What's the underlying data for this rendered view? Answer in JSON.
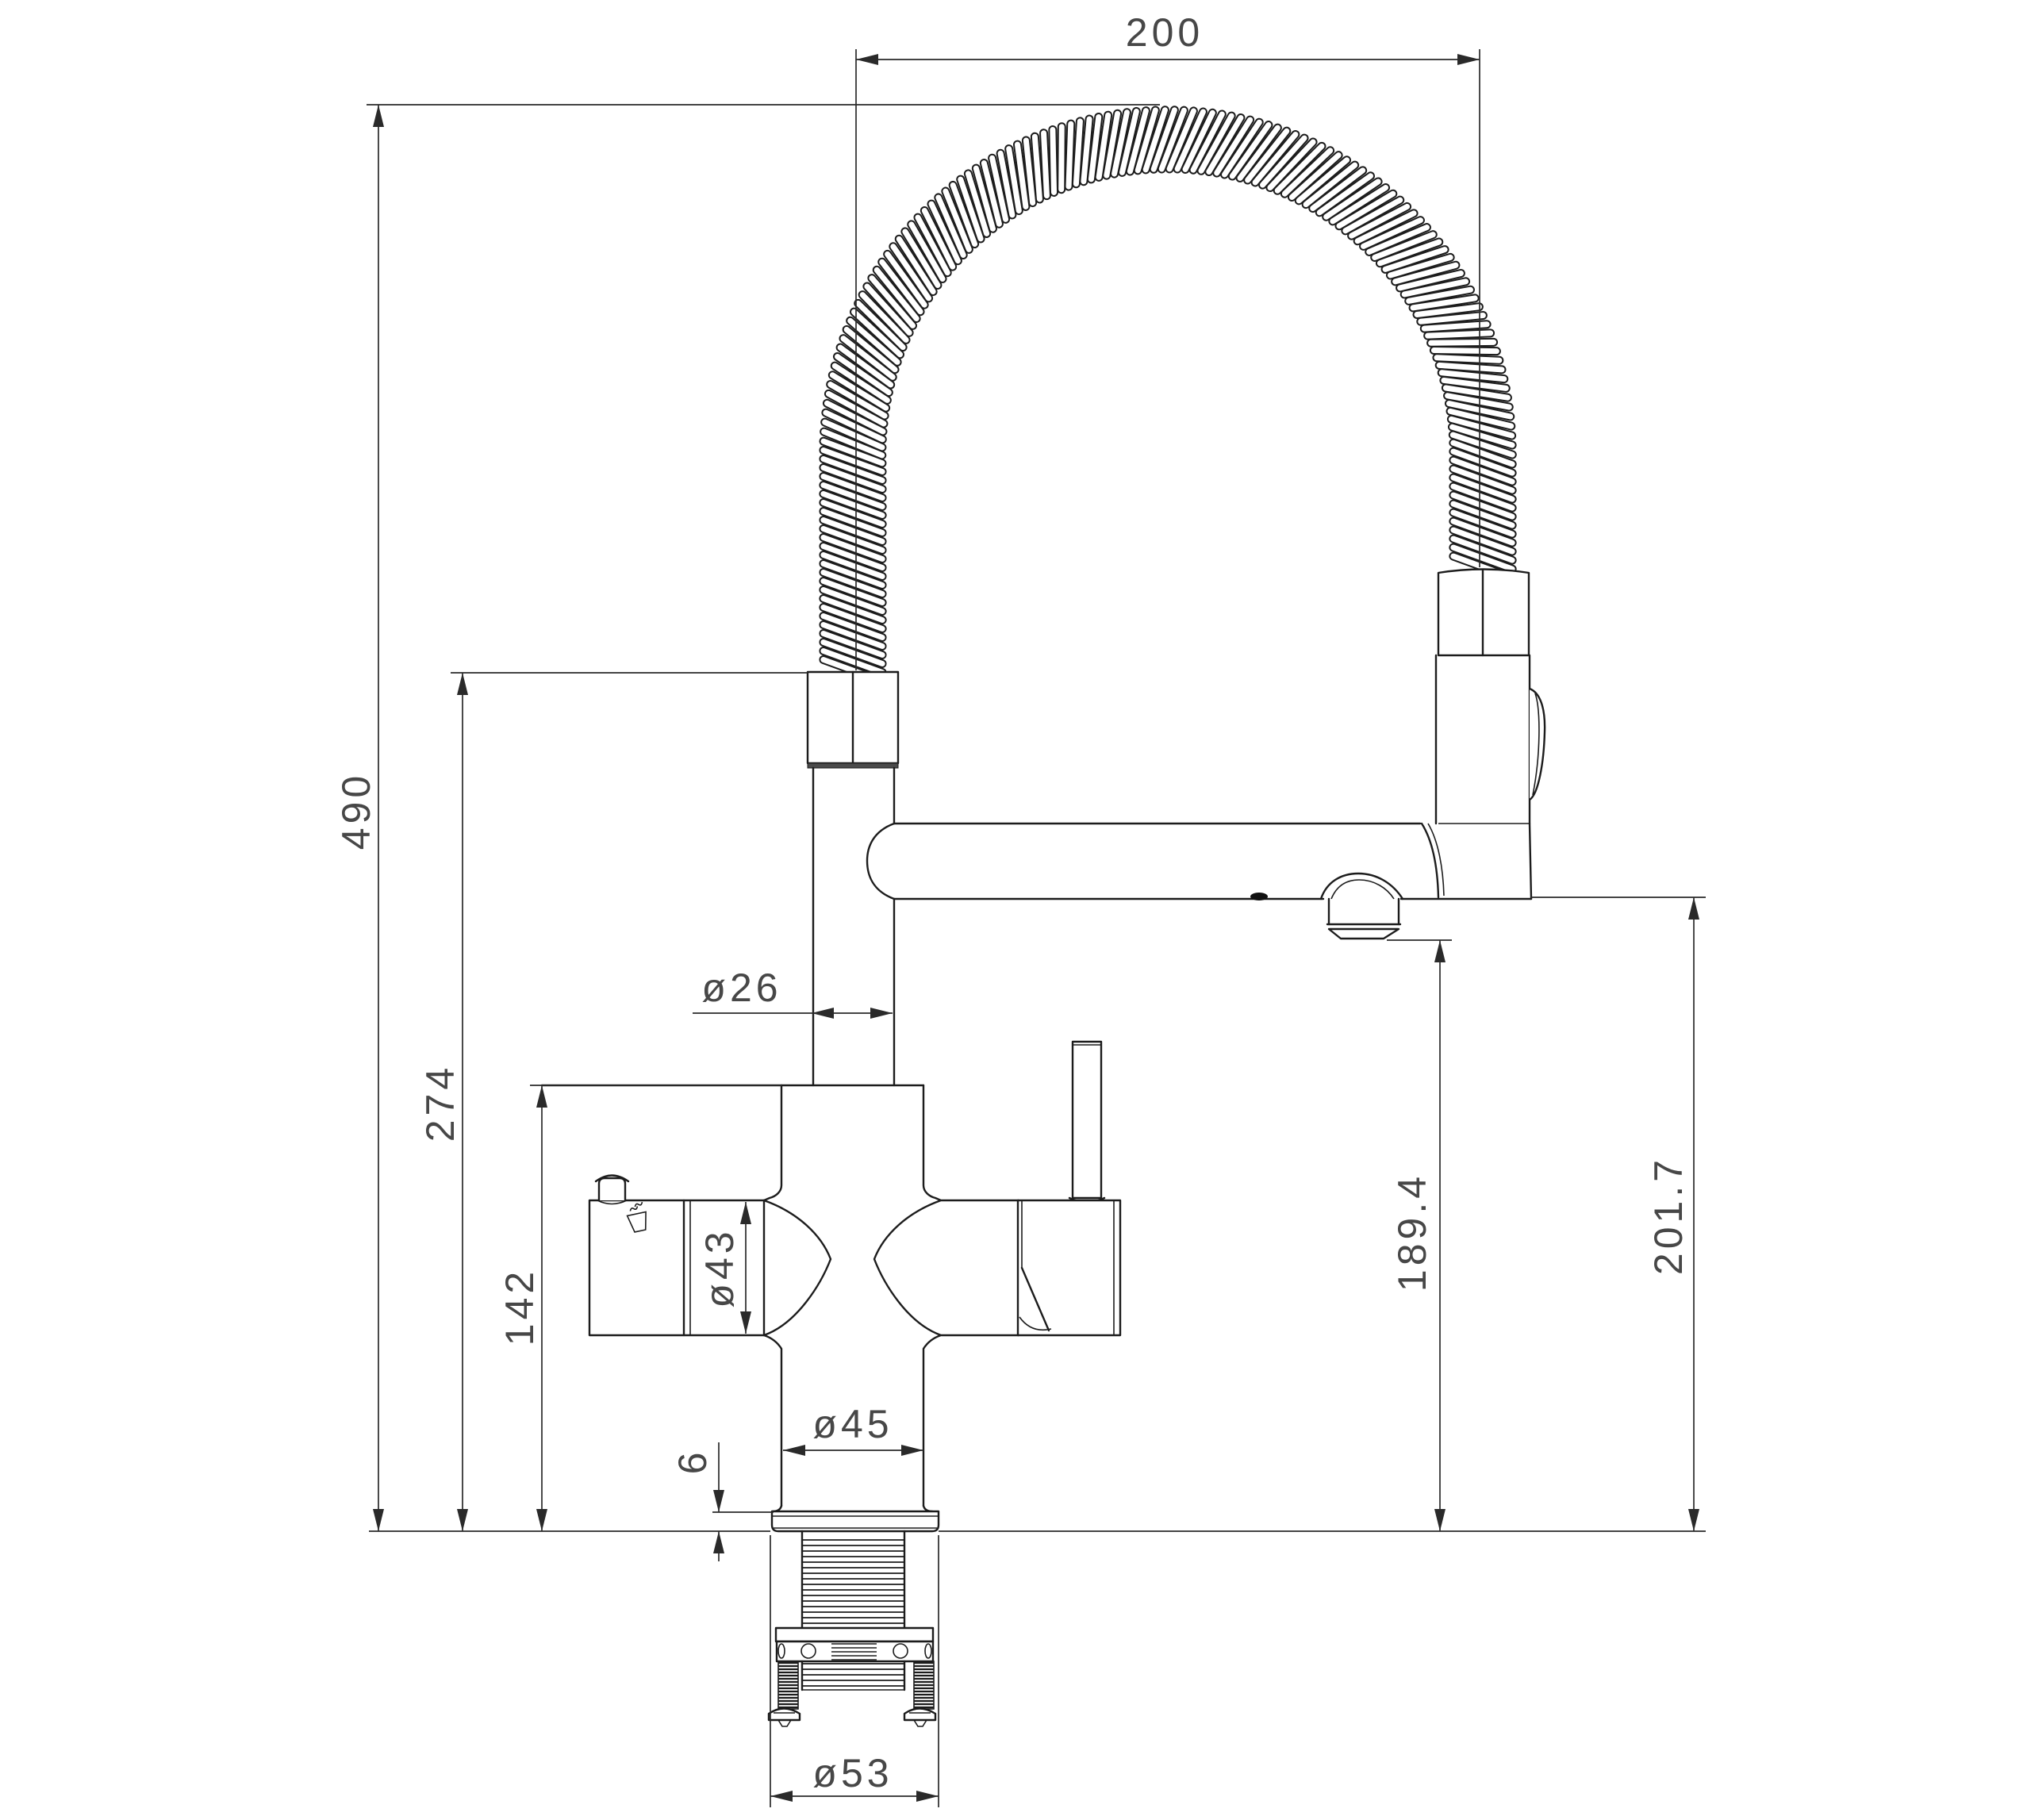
{
  "drawing": {
    "type": "technical-dimension-drawing",
    "subject": "kitchen mixer faucet with spring pull-down spout, side elevation",
    "background_color": "#ffffff",
    "line_color": "#1c1c1c",
    "dim_text_color": "#474747",
    "dims": {
      "top_reach": "200",
      "overall_height": "490",
      "hose_connection_height": "274",
      "body_height": "142",
      "riser_diameter": "ø26",
      "cartridge_diameter": "ø43",
      "body_diameter": "ø45",
      "deck_plate_thickness": "6",
      "aerator_outlet_height": "189.4",
      "spout_outlet_height": "201.7",
      "escutcheon_diameter": "ø53"
    },
    "icons": {
      "filter_box_symbol": "hot-water-cup-with-steam"
    }
  }
}
